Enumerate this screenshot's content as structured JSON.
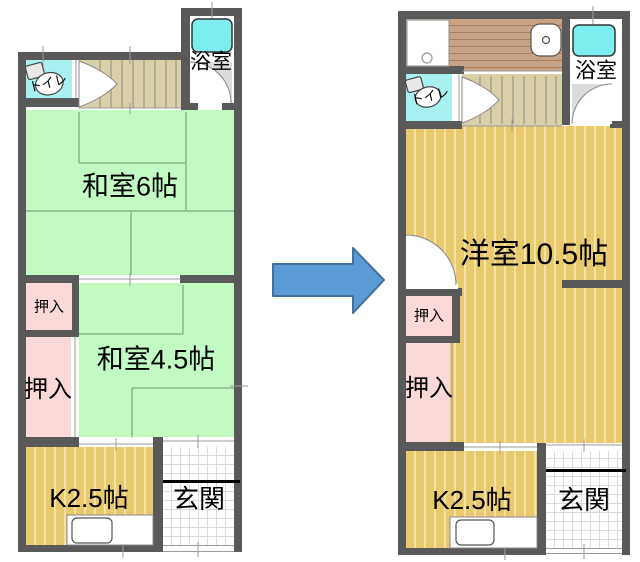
{
  "title": "floor-plan-renovation-comparison",
  "arrow": {
    "direction": "right",
    "fill": "#5b9bd5",
    "border": "#41719c"
  },
  "palette": {
    "wall": "#595959",
    "tatami": "#c2fbc2",
    "tatami_line": "#86b886",
    "closet": "#fbd9d9",
    "flooring": "#e9c96e",
    "flooring_stripe": "#f6e3a4",
    "stairs": "#d9d0a8",
    "water_floor": "#a9f0f0",
    "bathtub": "#7deef0",
    "deck": "#c7a284"
  },
  "before": {
    "rooms": {
      "bathroom": {
        "label": "浴室"
      },
      "toilet": {
        "label": "トイレ"
      },
      "tatami6": {
        "label": "和室6帖"
      },
      "tatami45": {
        "label": "和室4.5帖"
      },
      "closet_small": {
        "label": "押入"
      },
      "closet_large": {
        "label": "押入"
      },
      "kitchen": {
        "label": "K2.5帖"
      },
      "entrance": {
        "label": "玄関"
      }
    }
  },
  "after": {
    "rooms": {
      "bathroom": {
        "label": "浴室"
      },
      "toilet": {
        "label": "トイレ"
      },
      "western": {
        "label": "洋室10.5帖"
      },
      "closet_small": {
        "label": "押入"
      },
      "closet_large": {
        "label": "押入"
      },
      "kitchen": {
        "label": "K2.5帖"
      },
      "entrance": {
        "label": "玄関"
      }
    }
  }
}
